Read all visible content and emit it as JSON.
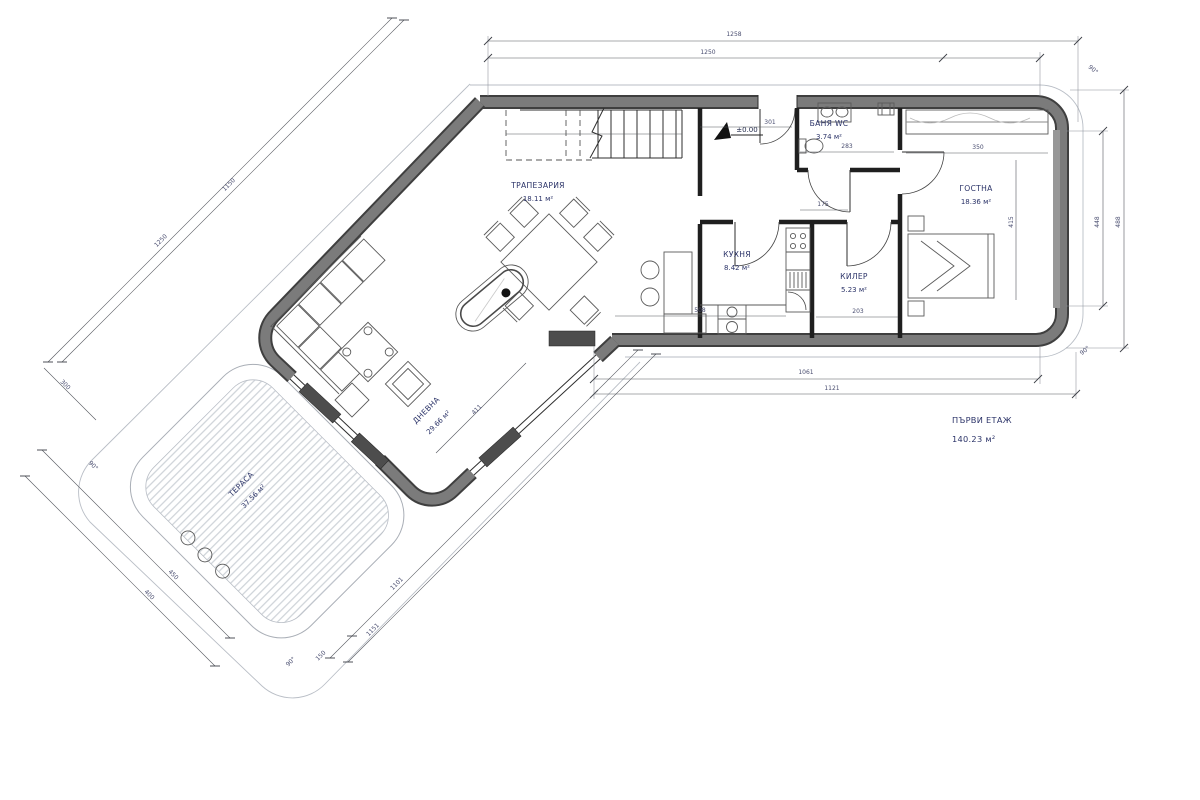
{
  "canvas": {
    "width": 1200,
    "height": 800,
    "background": "#ffffff"
  },
  "colors": {
    "wall_fill": "#7b7b7b",
    "wall_edge": "#3f3f3f",
    "line": "#2e2e2e",
    "glass_panel": "#4d4d4d",
    "deck_stripe": "#ccd1d7",
    "outline": "#b9bec6",
    "room_label": "#2b3368",
    "dim_label": "#4a4e70"
  },
  "rooms": [
    {
      "id": "dining",
      "name": "ТРАПЕЗАРИЯ",
      "area": "18.11 м²"
    },
    {
      "id": "kitchen",
      "name": "КУХНЯ",
      "area": "8.42 м²"
    },
    {
      "id": "bathroom",
      "name": "БАНЯ WC",
      "area": "3.74 м²"
    },
    {
      "id": "pantry",
      "name": "КИЛЕР",
      "area": "5.23 м²"
    },
    {
      "id": "guest-room",
      "name": "ГОСТНА",
      "area": "18.36 м²"
    },
    {
      "id": "living-room",
      "name": "ДНЕВНА",
      "area": "29.66 м²"
    },
    {
      "id": "terrace",
      "name": "ТЕРАСА",
      "area": "37.56 м²"
    }
  ],
  "floor_label": {
    "name": "ПЪРВИ ЕТАЖ",
    "area": "140.23 м²"
  },
  "level_marker": "±0.00",
  "dimensions": {
    "top_outer": "1258",
    "top_inner": "1250",
    "right_inner": "448",
    "right_outer": "488",
    "bottom_inner": "1061",
    "bottom_outer": "1121",
    "small": [
      "301",
      "283",
      "175",
      "350",
      "415",
      "508",
      "203",
      "411",
      "1150",
      "1250",
      "300",
      "450",
      "400",
      "1101",
      "1151",
      "150"
    ],
    "angles": [
      "90°",
      "90°",
      "90°",
      "90°"
    ]
  }
}
